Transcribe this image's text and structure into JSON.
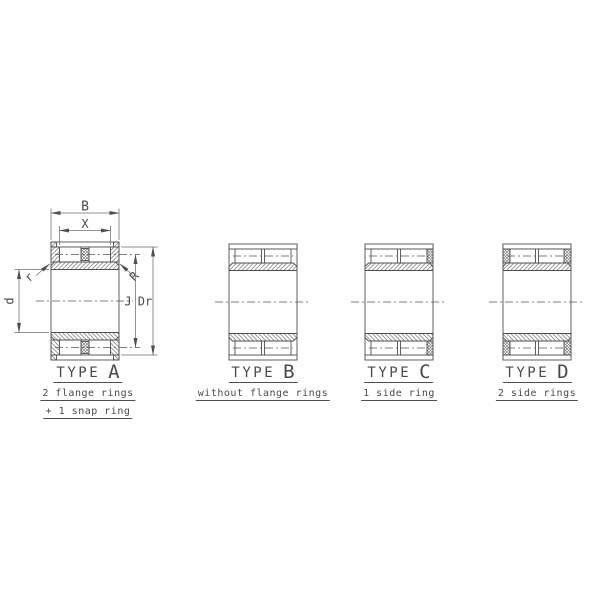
{
  "diagram": {
    "dimensions": {
      "total_width": "B",
      "roller_span": "X",
      "bore_diameter": "d",
      "inner_chamfer": "r",
      "outer_chamfer": "R",
      "flange_diameter": "J",
      "roller_outside_diameter": "Dr"
    },
    "types": [
      {
        "title": "TYPE",
        "letter": "A",
        "captions": [
          "2 flange rings",
          "+ 1 snap ring"
        ]
      },
      {
        "title": "TYPE",
        "letter": "B",
        "captions": [
          "without flange rings"
        ]
      },
      {
        "title": "TYPE",
        "letter": "C",
        "captions": [
          "1 side ring"
        ]
      },
      {
        "title": "TYPE",
        "letter": "D",
        "captions": [
          "2 side rings"
        ]
      }
    ],
    "colors": {
      "line": "#4f4f4f",
      "thin_line": "#6e6e6e",
      "text": "#4a4a4a",
      "background": "#ffffff"
    }
  }
}
